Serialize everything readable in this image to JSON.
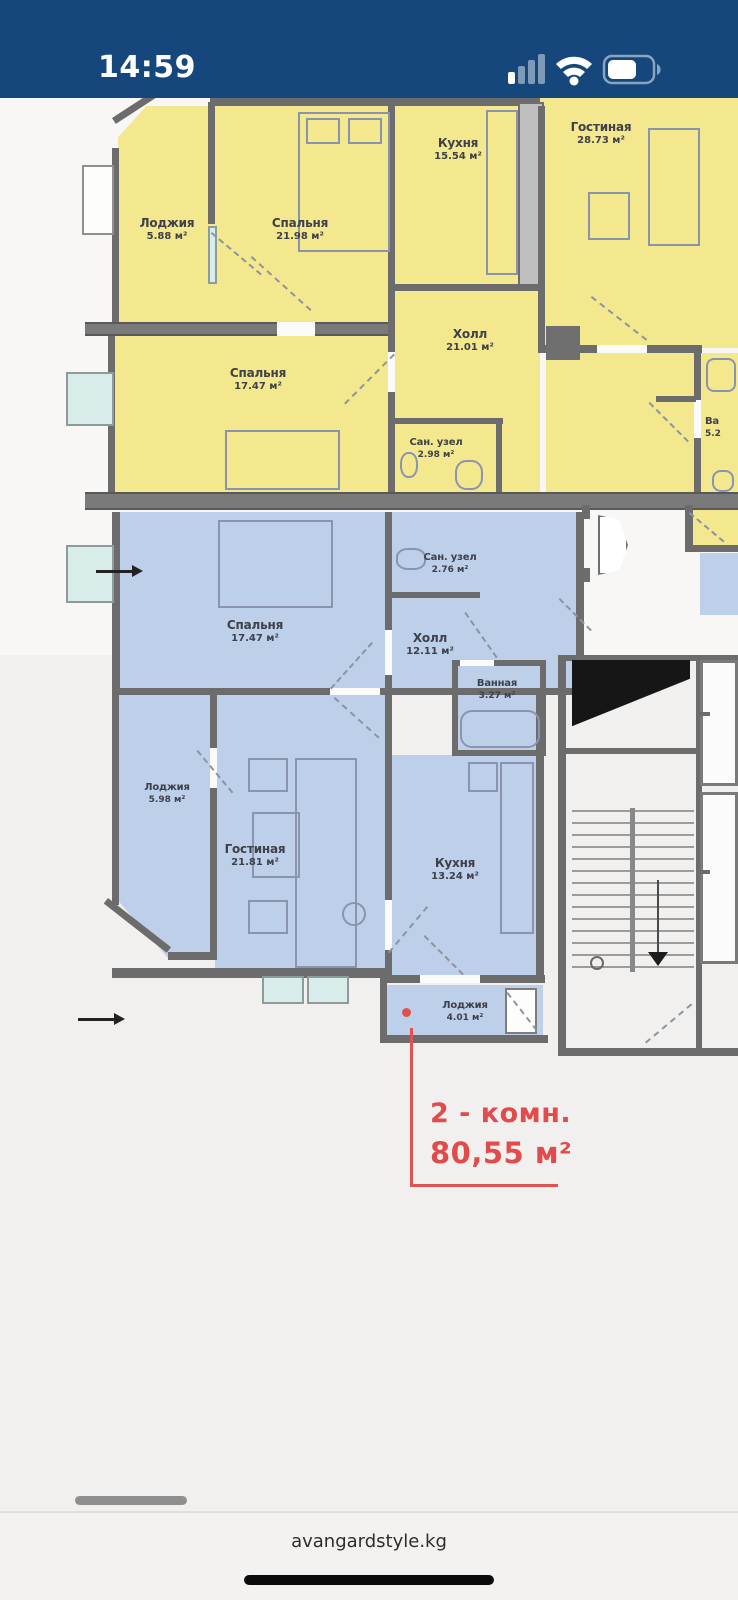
{
  "status_bar": {
    "time": "14:59",
    "icons": [
      "cellular-signal-icon",
      "wifi-icon",
      "battery-icon"
    ]
  },
  "plan": {
    "yellow_apartment": {
      "rooms": [
        {
          "name": "Лоджия",
          "area": "5.88 м²"
        },
        {
          "name": "Спальня",
          "area": "21.98 м²"
        },
        {
          "name": "Кухня",
          "area": "15.54 м²"
        },
        {
          "name": "Гостиная",
          "area": "28.73 м²"
        },
        {
          "name": "Холл",
          "area": "21.01 м²"
        },
        {
          "name": "Спальня",
          "area": "17.47 м²"
        },
        {
          "name": "Сан. узел",
          "area": "2.98 м²"
        }
      ]
    },
    "blue_apartment": {
      "rooms": [
        {
          "name": "Спальня",
          "area": "17.47 м²"
        },
        {
          "name": "Сан. узел",
          "area": "2.76 м²"
        },
        {
          "name": "Холл",
          "area": "12.11 м²"
        },
        {
          "name": "Ванная",
          "area": "3.27 м²"
        },
        {
          "name": "Лоджия",
          "area": "5.98 м²"
        },
        {
          "name": "Гостиная",
          "area": "21.81 м²"
        },
        {
          "name": "Кухня",
          "area": "13.24 м²"
        },
        {
          "name": "Лоджия",
          "area": "4.01 м²"
        }
      ]
    },
    "partial_room": {
      "name": "Ва",
      "area": "5.2"
    },
    "highlight_tag": {
      "rooms_line": "2 - комн.",
      "area_line": "80,55 м²"
    }
  },
  "footer": {
    "site_label": "avangardstyle.kg"
  },
  "colors": {
    "status_bar": "#15477c",
    "yellow_fill": "#f3e88d",
    "blue_fill": "#bdcfe9",
    "accent_red": "#e14b4b",
    "wall_gray": "#6c6c6c"
  }
}
